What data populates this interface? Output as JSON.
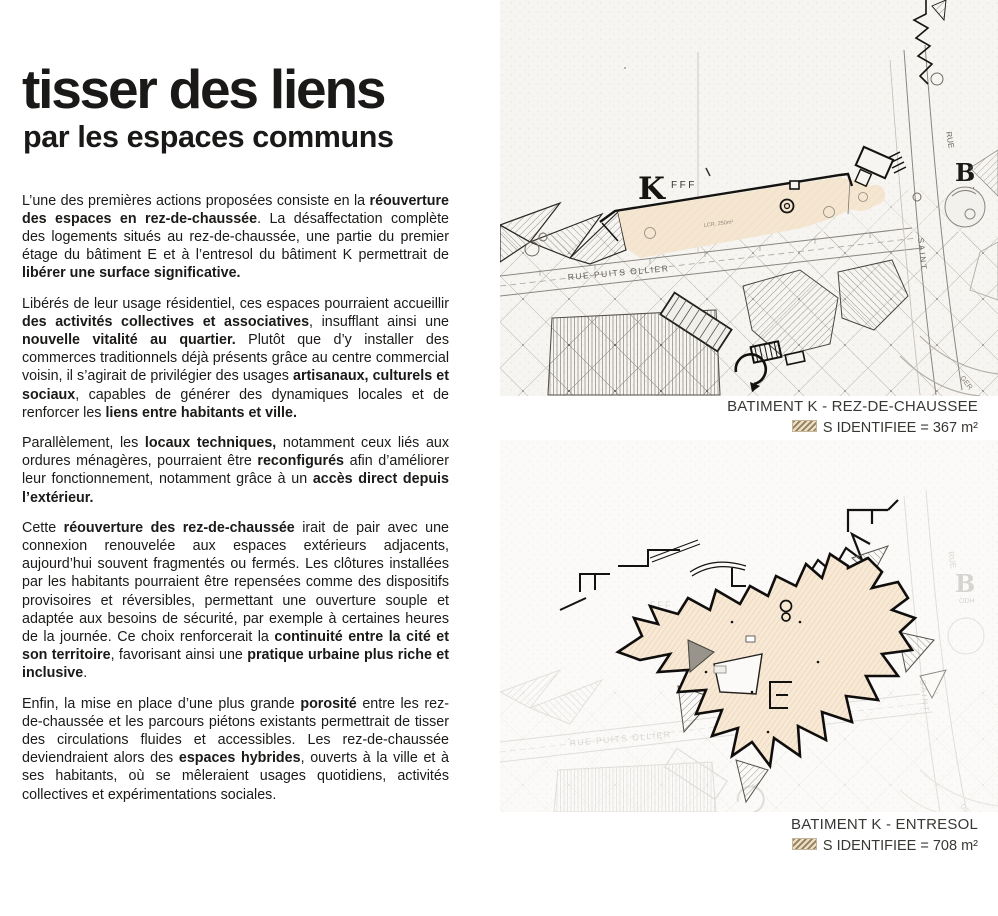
{
  "article": {
    "title": "tisser des liens",
    "subtitle": "par les espaces communs",
    "paragraphs": [
      [
        {
          "t": "L’une des premières actions proposées consiste en la ",
          "b": false
        },
        {
          "t": "réouverture des espaces en rez-de-chaussée",
          "b": true
        },
        {
          "t": ". La désaffectation complète des logements situés au rez-de-chaussée, une partie du premier étage du bâtiment E et à l’entresol du bâtiment K permettrait de ",
          "b": false
        },
        {
          "t": "libérer une surface significative.",
          "b": true
        }
      ],
      [
        {
          "t": "Libérés de leur usage résidentiel, ces espaces pourraient accueillir ",
          "b": false
        },
        {
          "t": "des activités collectives et associatives",
          "b": true
        },
        {
          "t": ", insufflant ainsi une ",
          "b": false
        },
        {
          "t": "nouvelle vitalité au quartier.",
          "b": true
        },
        {
          "t": " Plutôt que d’y installer des commerces traditionnels déjà présents grâce au centre commercial voisin, il s’agirait de privilégier des usages ",
          "b": false
        },
        {
          "t": "artisanaux, culturels et sociaux",
          "b": true
        },
        {
          "t": ", capables de générer des dynamiques locales et de renforcer les ",
          "b": false
        },
        {
          "t": "liens entre habitants et ville.",
          "b": true
        }
      ],
      [
        {
          "t": "Parallèlement, les ",
          "b": false
        },
        {
          "t": "locaux techniques,",
          "b": true
        },
        {
          "t": " notamment ceux liés aux ordures ménagères, pourraient être ",
          "b": false
        },
        {
          "t": "reconfigurés",
          "b": true
        },
        {
          "t": " afin d’améliorer leur fonctionnement, notamment grâce à un ",
          "b": false
        },
        {
          "t": "accès direct depuis l’extérieur.",
          "b": true
        }
      ],
      [
        {
          "t": "Cette ",
          "b": false
        },
        {
          "t": "réouverture des rez-de-chaussée",
          "b": true
        },
        {
          "t": " irait de pair avec une connexion renouvelée aux espaces extérieurs adjacents, aujourd’hui souvent fragmentés ou fermés. Les clôtures installées par les habitants pourraient être repensées comme des dispositifs provisoires et réversibles, permettant une ouverture souple et adaptée aux besoins de sécurité, par exemple à certaines heures de la journée. Ce choix renforcerait la ",
          "b": false
        },
        {
          "t": "continuité entre la cité et son territoire",
          "b": true
        },
        {
          "t": ", favorisant ainsi une ",
          "b": false
        },
        {
          "t": "pratique urbaine plus riche et inclusive",
          "b": true
        },
        {
          "t": ".",
          "b": false
        }
      ],
      [
        {
          "t": "Enfin, la mise en place d’une plus grande ",
          "b": false
        },
        {
          "t": "porosité",
          "b": true
        },
        {
          "t": " entre les rez-de-chaussée et les parcours piétons existants permettrait de tisser des circulations fluides et accessibles. Les rez-de-chaussée deviendraient alors des ",
          "b": false
        },
        {
          "t": "espaces hybrides",
          "b": true
        },
        {
          "t": ", ouverts à la ville et à ses habitants, où se mêleraient usages quotidiens, activités collectives et expérimentations sociales.",
          "b": false
        }
      ]
    ]
  },
  "figures": {
    "rdc": {
      "caption": "BATIMENT K - REZ-DE-CHAUSSEE",
      "legend": "S IDENTIFIEE = 367 m²"
    },
    "entresol": {
      "caption": "BATIMENT K - ENTRESOL",
      "legend": "S IDENTIFIEE = 708 m²"
    }
  },
  "map_labels": {
    "building_k": "K",
    "building_k_suffix": "FFF",
    "street_main": "RUE PUITS OLLIER",
    "street_side_1": "RUE",
    "street_side_2": "SAINT",
    "block_b": "B",
    "block_b_suffix": "ODH",
    "area_note": "LCR. 250m²",
    "corner_note": "GER"
  },
  "colors": {
    "highlight_fill": "#f5e6d1",
    "highlight_hatch": "#9b8763",
    "ink": "#141311",
    "paper": "#f7f5f2"
  }
}
